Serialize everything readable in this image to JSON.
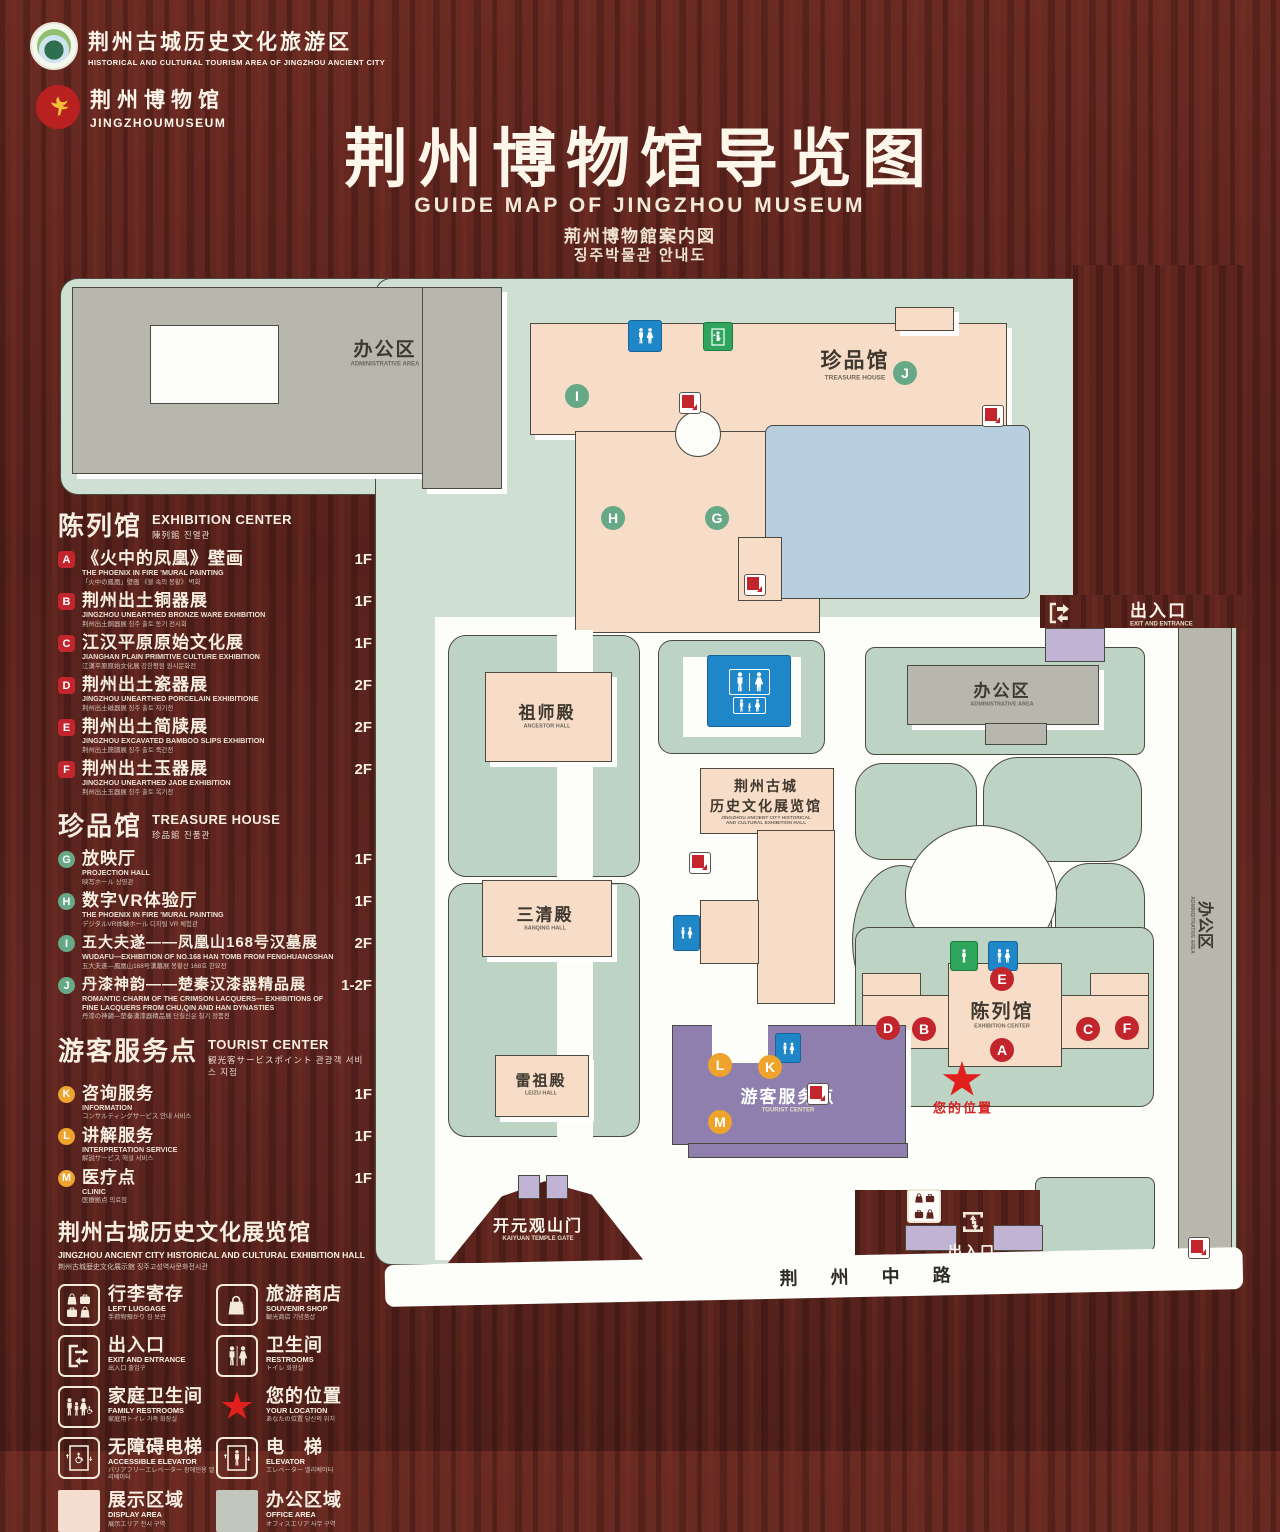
{
  "header": {
    "brand1": {
      "zh": "荆州古城历史文化旅游区",
      "en": "HISTORICAL AND CULTURAL TOURISM AREA OF JINGZHOU ANCIENT CITY"
    },
    "brand2": {
      "zh": "荆州博物馆",
      "en": "JINGZHOUMUSEUM"
    },
    "title": "荆州博物馆导览图",
    "subtitle_en": "GUIDE MAP OF JINGZHOU MUSEUM",
    "subtitle_ja": "荊州博物館案内図",
    "subtitle_ko": "징주박물관 안내도"
  },
  "legend": {
    "sections": [
      {
        "zh": "陈列馆",
        "en": "EXHIBITION CENTER",
        "sub": "陳列館  진열관",
        "items": [
          {
            "letter": "A",
            "zh": "《火中的凤凰》壁画",
            "en": "THE PHOENIX IN FIRE 'MURAL PAINTING",
            "jk": "「火中の鳳凰」壁画 《불 속의 봉황》 벽화",
            "floor": "1F"
          },
          {
            "letter": "B",
            "zh": "荆州出土铜器展",
            "en": "JINGZHOU UNEARTHED BRONZE WARE EXHIBITION",
            "jk": "荆州出土銅器展  징주 출토 동기 전시회",
            "floor": "1F"
          },
          {
            "letter": "C",
            "zh": "江汉平原原始文化展",
            "en": "JIANGHAN PLAIN PRIMITIVE CULTURE EXHIBITION",
            "jk": "江漢平原原始文化展  강한평원 원시문화전",
            "floor": "1F"
          },
          {
            "letter": "D",
            "zh": "荆州出土瓷器展",
            "en": "JINGZHOU UNEARTHED PORCELAIN EXHIBITIONE",
            "jk": "荆州出土磁器展  징주 출토 자기전",
            "floor": "2F"
          },
          {
            "letter": "E",
            "zh": "荆州出土简牍展",
            "en": "JINGZHOU EXCAVATED BAMBOO SLIPS EXHIBITION",
            "jk": "荆州出土簡牘展  징주 출토 죽간전",
            "floor": "2F"
          },
          {
            "letter": "F",
            "zh": "荆州出土玉器展",
            "en": "JINGZHOU UNEARTHED JADE EXHIBITION",
            "jk": "荆州出土玉器展  징주 출토 옥기전",
            "floor": "2F"
          }
        ]
      },
      {
        "zh": "珍品馆",
        "en": "TREASURE HOUSE",
        "sub": "珍品館  진품관",
        "items": [
          {
            "letter": "G",
            "zh": "放映厅",
            "en": "PROJECTION HALL",
            "jk": "映写ホール  상영관",
            "floor": "1F"
          },
          {
            "letter": "H",
            "zh": "数字VR体验厅",
            "en": "THE PHOENIX IN FIRE 'MURAL PAINTING",
            "jk": "デジタルVR体験ホール  디지털 VR 체험관",
            "floor": "1F"
          },
          {
            "letter": "I",
            "zh": "五大夫遂——凤凰山168号汉墓展",
            "en": "WUDAFU—EXHIBITION OF NO.168 HAN TOMB FROM FENGHUANGSHAN",
            "jk": "五大夫遂—鳳凰山168号漢墓展  봉황산 168호 한묘전",
            "floor": "2F"
          },
          {
            "letter": "J",
            "zh": "丹漆神韵——楚秦汉漆器精品展",
            "en": "ROMANTIC CHARM OF THE CRIMSON LACQUERS— EXHIBITIONS OF FINE LACQUERS FROM CHU,QIN AND HAN DYNASTIES",
            "jk": "丹漆の神韻—楚秦漢漆器精品展  단칠신운 칠기 정품전",
            "floor": "1-2F"
          }
        ]
      },
      {
        "zh": "游客服务点",
        "en": "TOURIST CENTER",
        "sub": "観光客サービスポイント  관광객 서비스 지점",
        "items": [
          {
            "letter": "K",
            "zh": "咨询服务",
            "en": "INFORMATION",
            "jk": "コンサルティングサービス  안내 서비스",
            "floor": "1F"
          },
          {
            "letter": "L",
            "zh": "讲解服务",
            "en": "INTERPRETATION SERVICE",
            "jk": "解説サービス  해설 서비스",
            "floor": "1F"
          },
          {
            "letter": "M",
            "zh": "医疗点",
            "en": "CLINIC",
            "jk": "医療拠点  의료점",
            "floor": "1F"
          }
        ]
      }
    ],
    "hall_note": {
      "zh": "荆州古城历史文化展览馆",
      "en": "JINGZHOU ANCIENT CITY HISTORICAL AND CULTURAL EXHIBITION HALL",
      "jk": "荆州古城歴史文化展示館  징주고성역사문화전시관"
    },
    "icons": [
      {
        "zh": "行李寄存",
        "en": "LEFT LUGGAGE",
        "jk": "手荷物預かり  짐 보관"
      },
      {
        "zh": "旅游商店",
        "en": "SOUVENIR SHOP",
        "jk": "観光商店  기념품샵"
      },
      {
        "zh": "出入口",
        "en": "EXIT AND ENTRANCE",
        "jk": "出入口  출입구"
      },
      {
        "zh": "卫生间",
        "en": "RESTROOMS",
        "jk": "トイレ  화장실"
      },
      {
        "zh": "家庭卫生间",
        "en": "FAMILY RESTROOMS",
        "jk": "家庭用トイレ  가족 화장실"
      },
      {
        "zh": "您的位置",
        "en": "YOUR LOCATION",
        "jk": "あなたの位置  당신의 위치"
      },
      {
        "zh": "无障碍电梯",
        "en": "ACCESSIBLE ELEVATOR",
        "jk": "バリアフリーエレベーター  장애인용 엘리베이터"
      },
      {
        "zh": "电　梯",
        "en": "ELEVATOR",
        "jk": "エレベーター  엘리베이터"
      }
    ],
    "areas": [
      {
        "zh": "展示区域",
        "en": "DISPLAY AREA",
        "jk": "展示エリア  전시 구역",
        "color": "#f4dcce"
      },
      {
        "zh": "办公区域",
        "en": "OFFICE AREA",
        "jk": "オフィスエリア  사무 구역",
        "color": "#c3c6bd"
      }
    ]
  },
  "map": {
    "labels": {
      "admin_top": {
        "zh": "办公区",
        "en": "ADMINISTRATIVE AREA"
      },
      "treasure": {
        "zh": "珍品馆",
        "en": "TREASURE HOUSE"
      },
      "ancestor": {
        "zh": "祖师殿",
        "en": "ANCESTOR HALL"
      },
      "sanqing": {
        "zh": "三清殿",
        "en": "SANQING HALL"
      },
      "leizu": {
        "zh": "雷祖殿",
        "en": "LEIZU HALL"
      },
      "history_hall": {
        "zh1": "荆州古城",
        "zh2": "历史文化展览馆",
        "en1": "JINGZHOU ANCIENT CITY HISTORICAL",
        "en2": "AND CULTURAL EXHIBITION HALL"
      },
      "admin_right": {
        "zh": "办公区",
        "en": "ADMINISTRATIVE AREA"
      },
      "admin_strip": {
        "zh": "办公区",
        "en": "ADMINISTRATIVE AREA"
      },
      "tourist": {
        "zh": "游客服务点",
        "en": "TOURIST CENTER"
      },
      "exhibition": {
        "zh": "陈列馆",
        "en": "EXHIBITION CENTER"
      },
      "location": {
        "zh": "您的位置"
      },
      "gate": {
        "zh": "开元观山门",
        "en": "KAIYUAN TEMPLE GATE"
      },
      "exit_top": {
        "zh": "出入口",
        "en": "EXIT AND ENTRANCE"
      },
      "exit_bottom": {
        "zh": "出入口",
        "en": "EXIT AND ENTRANCE"
      },
      "road": {
        "zh": "荆 州 中 路"
      }
    },
    "colors": {
      "campus_green": "#cfe0d2",
      "courtyard_green": "#bdd3c3",
      "building_pink": "#f7dcc8",
      "building_gray": "#b7b7ae",
      "water_blue": "#b7cede",
      "tourist_purple": "#8e7fae",
      "gate_purple": "#c0b3d4",
      "marker_red": "#c2252c",
      "marker_green": "#67a886",
      "marker_orange": "#eea32d",
      "star_red": "#e11f1b",
      "restroom_blue": "#1f86c8",
      "elevator_green": "#2fa45c",
      "wood_brown": "#5e251f"
    }
  }
}
